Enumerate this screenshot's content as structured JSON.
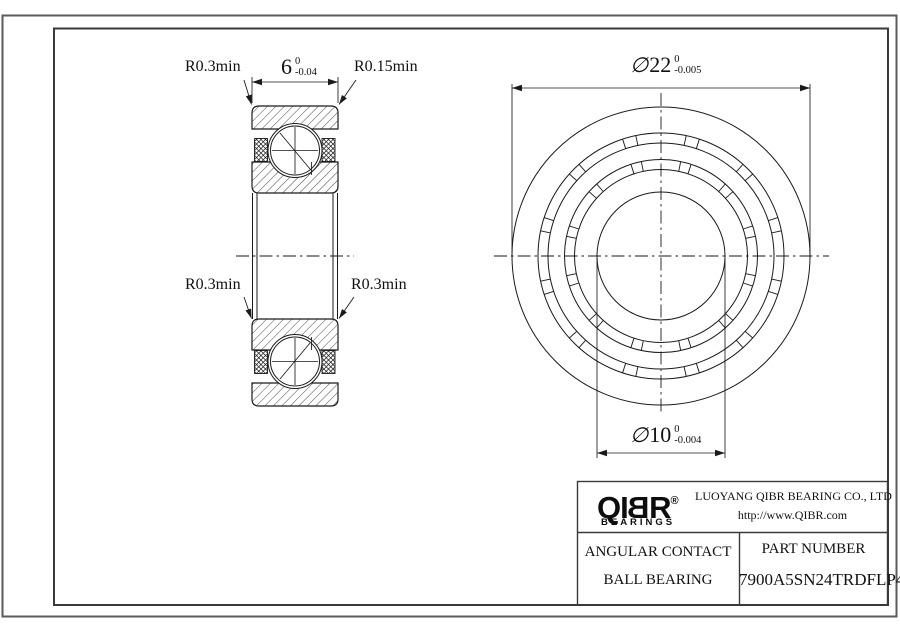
{
  "colors": {
    "background": "#ffffff",
    "line": "#1a1a1a",
    "frame_outer": "#5a5a5a",
    "frame_inner": "#3a3a3a",
    "text": "#111111"
  },
  "section_view": {
    "labels": {
      "top_left": "R0.3min",
      "top_right": "R0.15min",
      "bottom_left": "R0.3min",
      "bottom_right": "R0.3min"
    },
    "width_dim": {
      "value": "6",
      "upper": "0",
      "lower": "-0.04"
    }
  },
  "front_view": {
    "od_dim": {
      "symbol": "∅",
      "value": "22",
      "upper": "0",
      "lower": "-0.005"
    },
    "bore_dim": {
      "symbol": "∅",
      "value": "10",
      "upper": "0",
      "lower": "-0.004"
    }
  },
  "title_block": {
    "logo": {
      "letters": [
        "Q",
        "I",
        "B",
        "R"
      ],
      "registered": "®",
      "subtext": "BEARINGS"
    },
    "company": "LUOYANG QIBR BEARING CO., LTD",
    "website": "http://www.QIBR.com",
    "product_line1": "ANGULAR CONTACT",
    "product_line2": "BALL BEARING",
    "part_label": "PART NUMBER",
    "part_number": "7900A5SN24TRDFLP4"
  }
}
